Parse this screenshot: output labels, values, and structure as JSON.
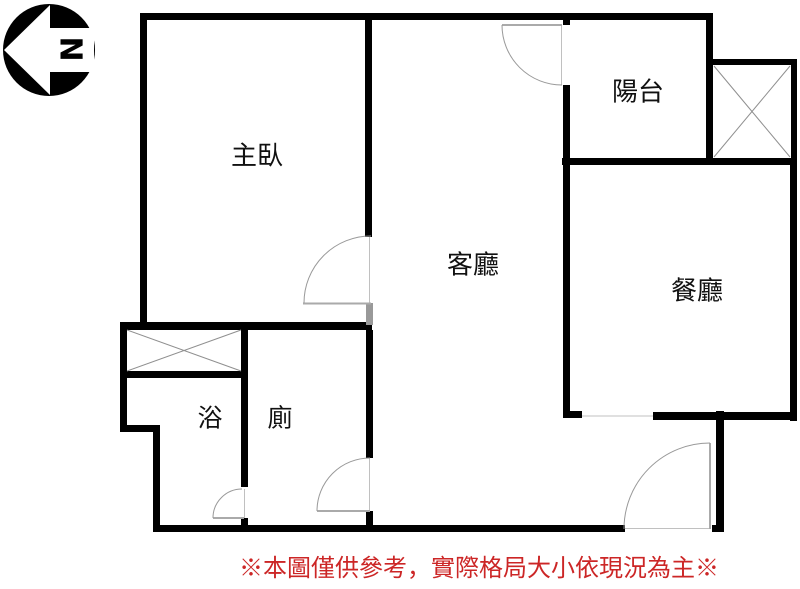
{
  "floor_plan": {
    "compass": {
      "label": "N"
    },
    "rooms": [
      {
        "id": "master-bedroom",
        "label": "主臥"
      },
      {
        "id": "balcony",
        "label": "陽台"
      },
      {
        "id": "living-room",
        "label": "客廳"
      },
      {
        "id": "dining-room",
        "label": "餐廳"
      },
      {
        "id": "bath",
        "label": "浴"
      },
      {
        "id": "toilet",
        "label": "廁"
      }
    ],
    "disclaimer": {
      "text": "※本圖僅供參考，實際格局大小依現況為主※",
      "color": "#cc2626"
    },
    "colors": {
      "wall": "#000000",
      "door_line": "#999999",
      "background": "#ffffff"
    }
  }
}
